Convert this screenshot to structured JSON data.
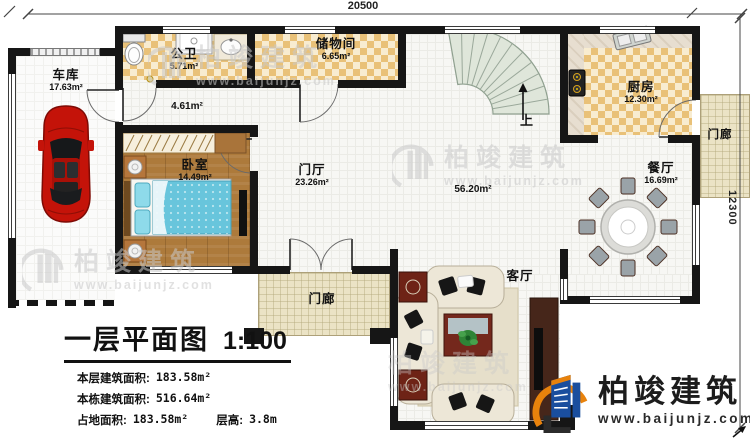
{
  "dimensions": {
    "width": "20500",
    "height": "12300"
  },
  "rooms": [
    {
      "name": "车库",
      "area": "17.63m²"
    },
    {
      "name": "公卫",
      "area": "5.71m²"
    },
    {
      "name": "储物间",
      "area": "6.65m²"
    },
    {
      "area": "4.61m²"
    },
    {
      "name": "卧室",
      "area": "14.49m²"
    },
    {
      "name": "门厅",
      "area": "23.26m²"
    },
    {
      "area": "56.20m²"
    },
    {
      "name": "厨房",
      "area": "12.30m²"
    },
    {
      "name": "餐厅",
      "area": "16.69m²"
    },
    {
      "name": "客厅"
    },
    {
      "name": "门廊"
    },
    {
      "name": "门廊"
    },
    {
      "label": "上"
    }
  ],
  "title_block": {
    "title": "一层平面图",
    "scale": "1:100",
    "stats": [
      {
        "label": "本层建筑面积:",
        "value": "183.58m²"
      },
      {
        "label": "本栋建筑面积:",
        "value": "516.64m²"
      },
      {
        "label": "占地面积:",
        "value": "183.58m²"
      },
      {
        "label": "层高:",
        "value": "3.8m"
      }
    ]
  },
  "branding": {
    "company": "柏竣建筑",
    "website": "www.baijunjz.com"
  },
  "watermark": {
    "company": "柏竣建筑",
    "website": "www.baijunjz.com"
  },
  "colors": {
    "wall": "#161616",
    "tile_dark": "#e9c178",
    "tile_light": "#f8ecd0",
    "wood_floor": "#ad7a3b",
    "porch_floor": "#ebe3c5",
    "stair_fill": "#dfe6da",
    "logo_blue": "#1a4e9e",
    "logo_orange": "#e8820c",
    "car_red": "#c41309",
    "bed_blue": "#68c5dc"
  }
}
